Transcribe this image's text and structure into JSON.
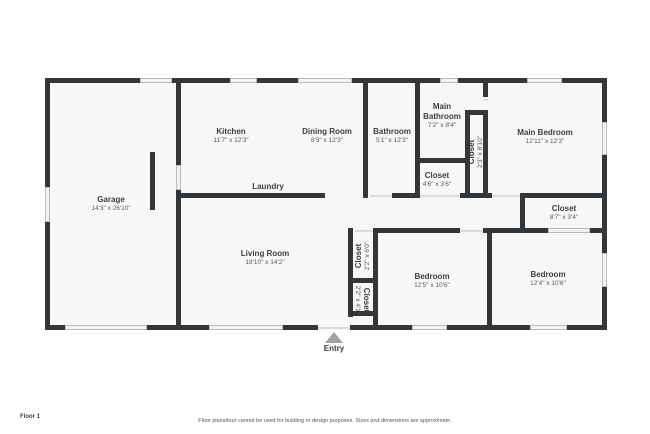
{
  "colors": {
    "wall": "#33373a",
    "floor_fill": "#f7f7f8",
    "window_fill": "#f2f2f2",
    "window_border": "#b9bcbf",
    "door_line": "#dcdcdc",
    "entry_arrow": "#a3a3a3",
    "label_text": "#3b3e42"
  },
  "footer": {
    "floor_label": "Floor 1",
    "disclaimer": "Floor plans/tour cannot be used for building or design purposes. Sizes and dimensions are approximate."
  },
  "entry": {
    "label": "Entry",
    "cx": 334,
    "triangle_x": 325,
    "triangle_y": 332,
    "label_y": 344
  },
  "plan_bounds": {
    "x": 45,
    "y": 78,
    "w": 562,
    "h": 252
  },
  "rooms": [
    {
      "name": "Garage",
      "dims": "14'3\" x 26'10\"",
      "cx": 111,
      "cy": 204,
      "rot": 0
    },
    {
      "name": "Kitchen",
      "dims": "11'7\" x 12'3\"",
      "cx": 231,
      "cy": 136,
      "rot": 0
    },
    {
      "name": "Dining Room",
      "dims": "8'9\" x 12'3\"",
      "cx": 327,
      "cy": 136,
      "rot": 0
    },
    {
      "name": "Bathroom",
      "dims": "5'1\" x 12'3\"",
      "cx": 392,
      "cy": 136,
      "rot": 0
    },
    {
      "name": "Main Bathroom",
      "dims": "7'2\" x 8'4\"",
      "cx": 442,
      "cy": 116,
      "rot": 0,
      "wrap": true
    },
    {
      "name": "Main Bedroom",
      "dims": "12'11\" x 12'3\"",
      "cx": 545,
      "cy": 137,
      "rot": 0
    },
    {
      "name": "Closet",
      "dims": "2'3\" x 8'10\"",
      "cx": 476,
      "cy": 152,
      "rot": -90
    },
    {
      "name": "Closet",
      "dims": "4'6\" x 3'6\"",
      "cx": 437,
      "cy": 180,
      "rot": 0
    },
    {
      "name": "Closet",
      "dims": "8'7\" x 3'4\"",
      "cx": 564,
      "cy": 213,
      "rot": 0
    },
    {
      "name": "Laundry",
      "dims": "",
      "cx": 268,
      "cy": 187,
      "rot": 0
    },
    {
      "name": "Living Room",
      "dims": "18'10\" x 14'2\"",
      "cx": 265,
      "cy": 258,
      "rot": 0
    },
    {
      "name": "Closet",
      "dims": "2'2\" x 6'0\"",
      "cx": 363,
      "cy": 256,
      "rot": -90
    },
    {
      "name": "Closet",
      "dims": "2'2\" x 4'1\"",
      "cx": 362,
      "cy": 300,
      "rot": 90
    },
    {
      "name": "Bedroom",
      "dims": "12'5\" x 10'6\"",
      "cx": 432,
      "cy": 281,
      "rot": 0
    },
    {
      "name": "Bedroom",
      "dims": "12'4\" x 10'6\"",
      "cx": 548,
      "cy": 279,
      "rot": 0
    }
  ],
  "walls": [
    [
      45,
      78,
      95,
      5
    ],
    [
      172,
      78,
      58,
      5
    ],
    [
      257,
      78,
      41,
      5
    ],
    [
      352,
      78,
      88,
      5
    ],
    [
      458,
      78,
      69,
      5
    ],
    [
      562,
      78,
      45,
      5
    ],
    [
      45,
      325,
      20,
      5
    ],
    [
      147,
      325,
      62,
      5
    ],
    [
      283,
      325,
      35,
      5
    ],
    [
      350,
      325,
      62,
      5
    ],
    [
      447,
      325,
      83,
      5
    ],
    [
      567,
      325,
      40,
      5
    ],
    [
      45,
      78,
      5,
      109
    ],
    [
      45,
      222,
      5,
      108
    ],
    [
      602,
      78,
      5,
      44
    ],
    [
      602,
      155,
      5,
      98
    ],
    [
      602,
      287,
      5,
      43
    ],
    [
      176,
      83,
      5,
      82
    ],
    [
      176,
      190,
      5,
      140
    ],
    [
      150,
      152,
      5,
      58
    ],
    [
      178,
      193,
      147,
      5
    ],
    [
      363,
      83,
      5,
      115
    ],
    [
      415,
      83,
      5,
      115
    ],
    [
      415,
      158,
      55,
      5
    ],
    [
      465,
      110,
      23,
      5
    ],
    [
      465,
      115,
      5,
      83
    ],
    [
      483,
      83,
      5,
      14
    ],
    [
      483,
      112,
      5,
      86
    ],
    [
      392,
      193,
      28,
      5
    ],
    [
      460,
      193,
      32,
      5
    ],
    [
      520,
      193,
      87,
      5
    ],
    [
      520,
      198,
      5,
      35
    ],
    [
      520,
      228,
      28,
      5
    ],
    [
      590,
      228,
      17,
      5
    ],
    [
      373,
      228,
      87,
      5
    ],
    [
      483,
      228,
      37,
      5
    ],
    [
      348,
      228,
      5,
      89
    ],
    [
      373,
      228,
      5,
      102
    ],
    [
      348,
      278,
      30,
      5
    ],
    [
      348,
      311,
      30,
      5
    ],
    [
      487,
      233,
      5,
      92
    ]
  ],
  "windows": [
    [
      140,
      78,
      32,
      5
    ],
    [
      230,
      78,
      27,
      5
    ],
    [
      298,
      78,
      54,
      5
    ],
    [
      440,
      78,
      18,
      5
    ],
    [
      527,
      78,
      35,
      5
    ],
    [
      65,
      325,
      82,
      5
    ],
    [
      209,
      325,
      74,
      5
    ],
    [
      412,
      325,
      35,
      5
    ],
    [
      530,
      325,
      37,
      5
    ],
    [
      45,
      187,
      5,
      35
    ],
    [
      602,
      122,
      5,
      33
    ],
    [
      602,
      253,
      5,
      34
    ],
    [
      176,
      165,
      5,
      25
    ],
    [
      548,
      228,
      42,
      5
    ]
  ],
  "doors": [
    [
      370,
      195,
      22,
      2
    ],
    [
      420,
      195,
      40,
      2
    ],
    [
      492,
      195,
      28,
      2
    ],
    [
      355,
      230,
      18,
      2
    ],
    [
      460,
      230,
      23,
      2
    ],
    [
      483,
      99,
      5,
      2
    ],
    [
      318,
      327,
      32,
      2
    ]
  ]
}
